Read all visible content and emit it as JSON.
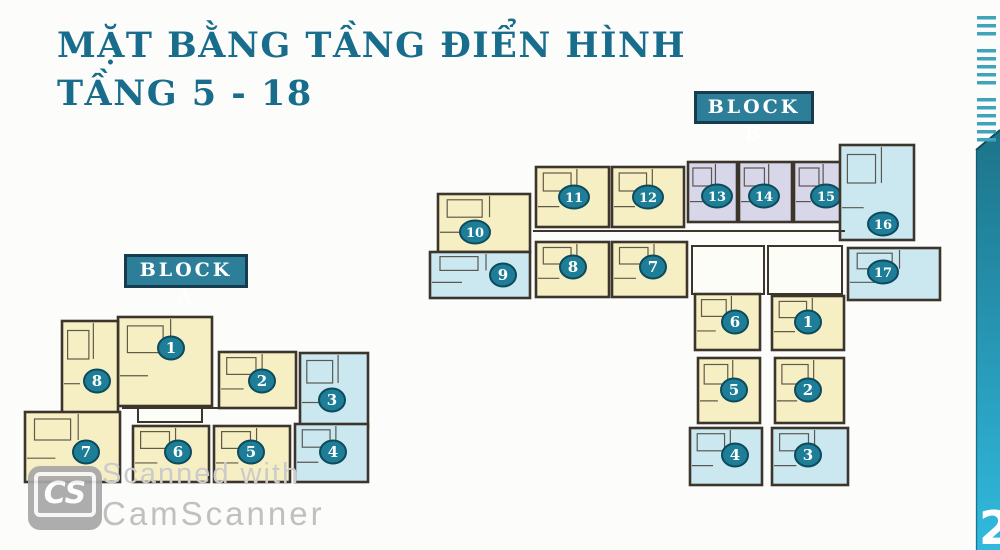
{
  "title": {
    "line1": "MẶT BẰNG TẦNG ĐIỂN HÌNH",
    "line2": "TẦNG 5 - 18"
  },
  "palette": {
    "cream": "#f7efc4",
    "blue": "#cbe8f1",
    "lavender": "#d8d7ea",
    "wall": "#3c352b",
    "badge_fill": "#1e7e97",
    "badge_stroke": "#0c4a5c",
    "badge_text": "#ffffff",
    "title_color": "#186d8d",
    "label_bg": "#2d7f99",
    "label_border": "#163c4e",
    "bar_top": "#1d7389",
    "bar_bottom": "#31bade",
    "dash_color": "#3fa3ba",
    "watermark_gray": "#c6c6c6"
  },
  "blocks": [
    {
      "id": "A",
      "label": "BLOCK A",
      "units": [
        {
          "n": "1",
          "x": 118,
          "y": 317,
          "w": 94,
          "h": 89,
          "c": "cream",
          "bx": 171,
          "by": 348
        },
        {
          "n": "8",
          "x": 62,
          "y": 321,
          "w": 56,
          "h": 95,
          "c": "cream",
          "bx": 97,
          "by": 381
        },
        {
          "n": "2",
          "x": 219,
          "y": 352,
          "w": 77,
          "h": 56,
          "c": "cream",
          "bx": 262,
          "by": 381
        },
        {
          "n": "3",
          "x": 300,
          "y": 353,
          "w": 68,
          "h": 75,
          "c": "blue",
          "bx": 332,
          "by": 400
        },
        {
          "n": "7",
          "x": 25,
          "y": 412,
          "w": 95,
          "h": 70,
          "c": "cream",
          "bx": 86,
          "by": 452
        },
        {
          "n": "6",
          "x": 133,
          "y": 426,
          "w": 76,
          "h": 56,
          "c": "cream",
          "bx": 178,
          "by": 452
        },
        {
          "n": "5",
          "x": 214,
          "y": 426,
          "w": 76,
          "h": 56,
          "c": "cream",
          "bx": 251,
          "by": 452
        },
        {
          "n": "4",
          "x": 295,
          "y": 424,
          "w": 73,
          "h": 58,
          "c": "blue",
          "bx": 333,
          "by": 452
        }
      ],
      "extras": [
        {
          "x": 138,
          "y": 398,
          "w": 64,
          "h": 24
        }
      ],
      "lines": [
        [
          122,
          408,
          296,
          408
        ]
      ]
    },
    {
      "id": "B",
      "label": "BLOCK B",
      "units": [
        {
          "n": "10",
          "x": 438,
          "y": 194,
          "w": 92,
          "h": 58,
          "c": "cream",
          "bx": 475,
          "by": 232
        },
        {
          "n": "9",
          "x": 430,
          "y": 252,
          "w": 100,
          "h": 46,
          "c": "blue",
          "bx": 503,
          "by": 275
        },
        {
          "n": "11",
          "x": 536,
          "y": 167,
          "w": 73,
          "h": 60,
          "c": "cream",
          "bx": 574,
          "by": 197
        },
        {
          "n": "12",
          "x": 612,
          "y": 167,
          "w": 72,
          "h": 60,
          "c": "cream",
          "bx": 648,
          "by": 197
        },
        {
          "n": "13",
          "x": 688,
          "y": 162,
          "w": 49,
          "h": 60,
          "c": "lavender",
          "bx": 717,
          "by": 196
        },
        {
          "n": "14",
          "x": 739,
          "y": 162,
          "w": 53,
          "h": 60,
          "c": "lavender",
          "bx": 764,
          "by": 196
        },
        {
          "n": "15",
          "x": 794,
          "y": 162,
          "w": 52,
          "h": 60,
          "c": "lavender",
          "bx": 826,
          "by": 196
        },
        {
          "n": "16",
          "x": 840,
          "y": 145,
          "w": 74,
          "h": 95,
          "c": "blue",
          "bx": 883,
          "by": 224
        },
        {
          "n": "8",
          "x": 536,
          "y": 242,
          "w": 73,
          "h": 55,
          "c": "cream",
          "bx": 573,
          "by": 267
        },
        {
          "n": "7",
          "x": 612,
          "y": 242,
          "w": 75,
          "h": 55,
          "c": "cream",
          "bx": 653,
          "by": 267
        },
        {
          "n": "17",
          "x": 848,
          "y": 248,
          "w": 92,
          "h": 52,
          "c": "blue",
          "bx": 883,
          "by": 272
        },
        {
          "n": "6",
          "x": 695,
          "y": 294,
          "w": 65,
          "h": 56,
          "c": "cream",
          "bx": 735,
          "by": 322
        },
        {
          "n": "1",
          "x": 772,
          "y": 296,
          "w": 72,
          "h": 54,
          "c": "cream",
          "bx": 808,
          "by": 322
        },
        {
          "n": "5",
          "x": 698,
          "y": 358,
          "w": 62,
          "h": 65,
          "c": "cream",
          "bx": 734,
          "by": 390
        },
        {
          "n": "2",
          "x": 775,
          "y": 358,
          "w": 69,
          "h": 65,
          "c": "cream",
          "bx": 808,
          "by": 390
        },
        {
          "n": "4",
          "x": 690,
          "y": 428,
          "w": 72,
          "h": 57,
          "c": "blue",
          "bx": 735,
          "by": 455
        },
        {
          "n": "3",
          "x": 772,
          "y": 428,
          "w": 76,
          "h": 57,
          "c": "blue",
          "bx": 808,
          "by": 455
        }
      ],
      "extras": [
        {
          "x": 692,
          "y": 246,
          "w": 72,
          "h": 48
        },
        {
          "x": 768,
          "y": 246,
          "w": 74,
          "h": 48
        }
      ],
      "lines": [
        [
          533,
          231,
          845,
          231
        ]
      ]
    }
  ],
  "watermark": {
    "logo_text": "CS",
    "line1": "Scanned with",
    "line2": "CamScanner"
  },
  "sidebar": {
    "dash_groups": [
      3,
      5,
      6
    ],
    "page_number": "2"
  }
}
